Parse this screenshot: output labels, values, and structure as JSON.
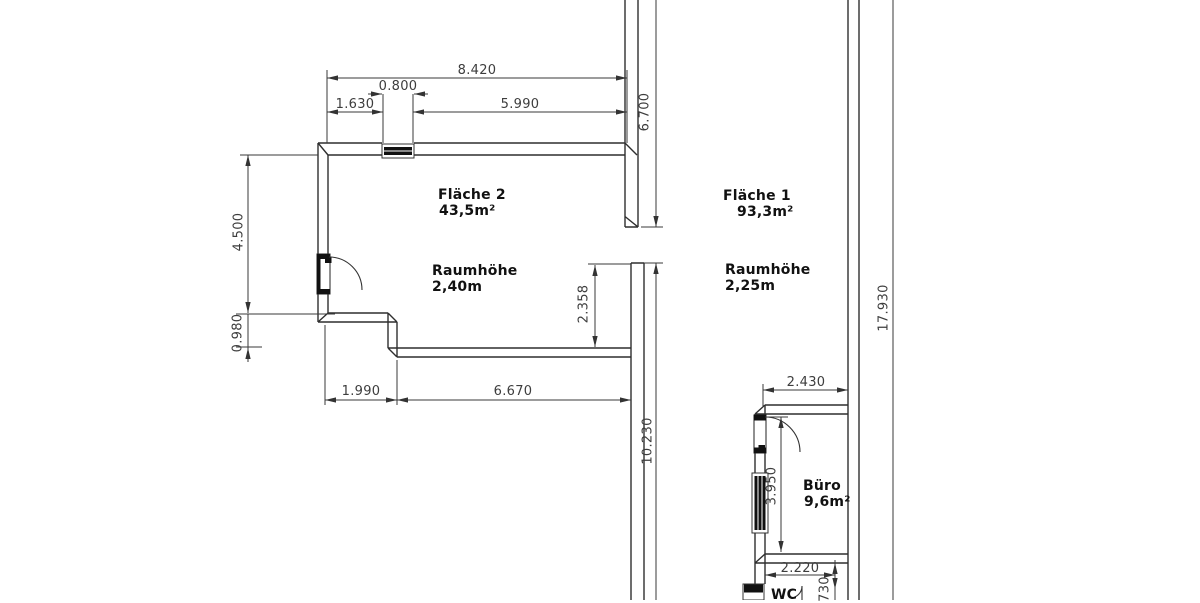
{
  "plan": {
    "rooms": {
      "flaeche2": {
        "name": "Fläche 2",
        "area": "43,5m²",
        "height_label": "Raumhöhe",
        "height_value": "2,40m"
      },
      "flaeche1": {
        "name": "Fläche 1",
        "area": "93,3m²",
        "height_label": "Raumhöhe",
        "height_value": "2,25m"
      },
      "buero": {
        "name": "Büro",
        "area": "9,6m²"
      },
      "wc": {
        "name": "WC"
      }
    },
    "dims": {
      "total_top_width": "8.420",
      "window_width": "0.800",
      "left_of_window": "1.630",
      "right_of_window": "5.990",
      "upper_mid_height": "6.700",
      "left_room_height": "4.500",
      "left_step_height": "0.980",
      "mid_passage_height": "2.358",
      "bottom_left_width": "1.990",
      "bottom_right_width": "6.670",
      "lower_mid_height": "10.230",
      "total_right_height": "17.930",
      "buero_width": "2.430",
      "buero_height": "3.950",
      "wc_width": "2.220",
      "wc_height": "730"
    },
    "colors": {
      "background": "#ffffff",
      "wall_line": "#2f2f2f",
      "dim_line": "#3a3a3a",
      "dim_text": "#3d3d3d",
      "room_text": "#111111",
      "symbol_fill": "#111111"
    }
  }
}
